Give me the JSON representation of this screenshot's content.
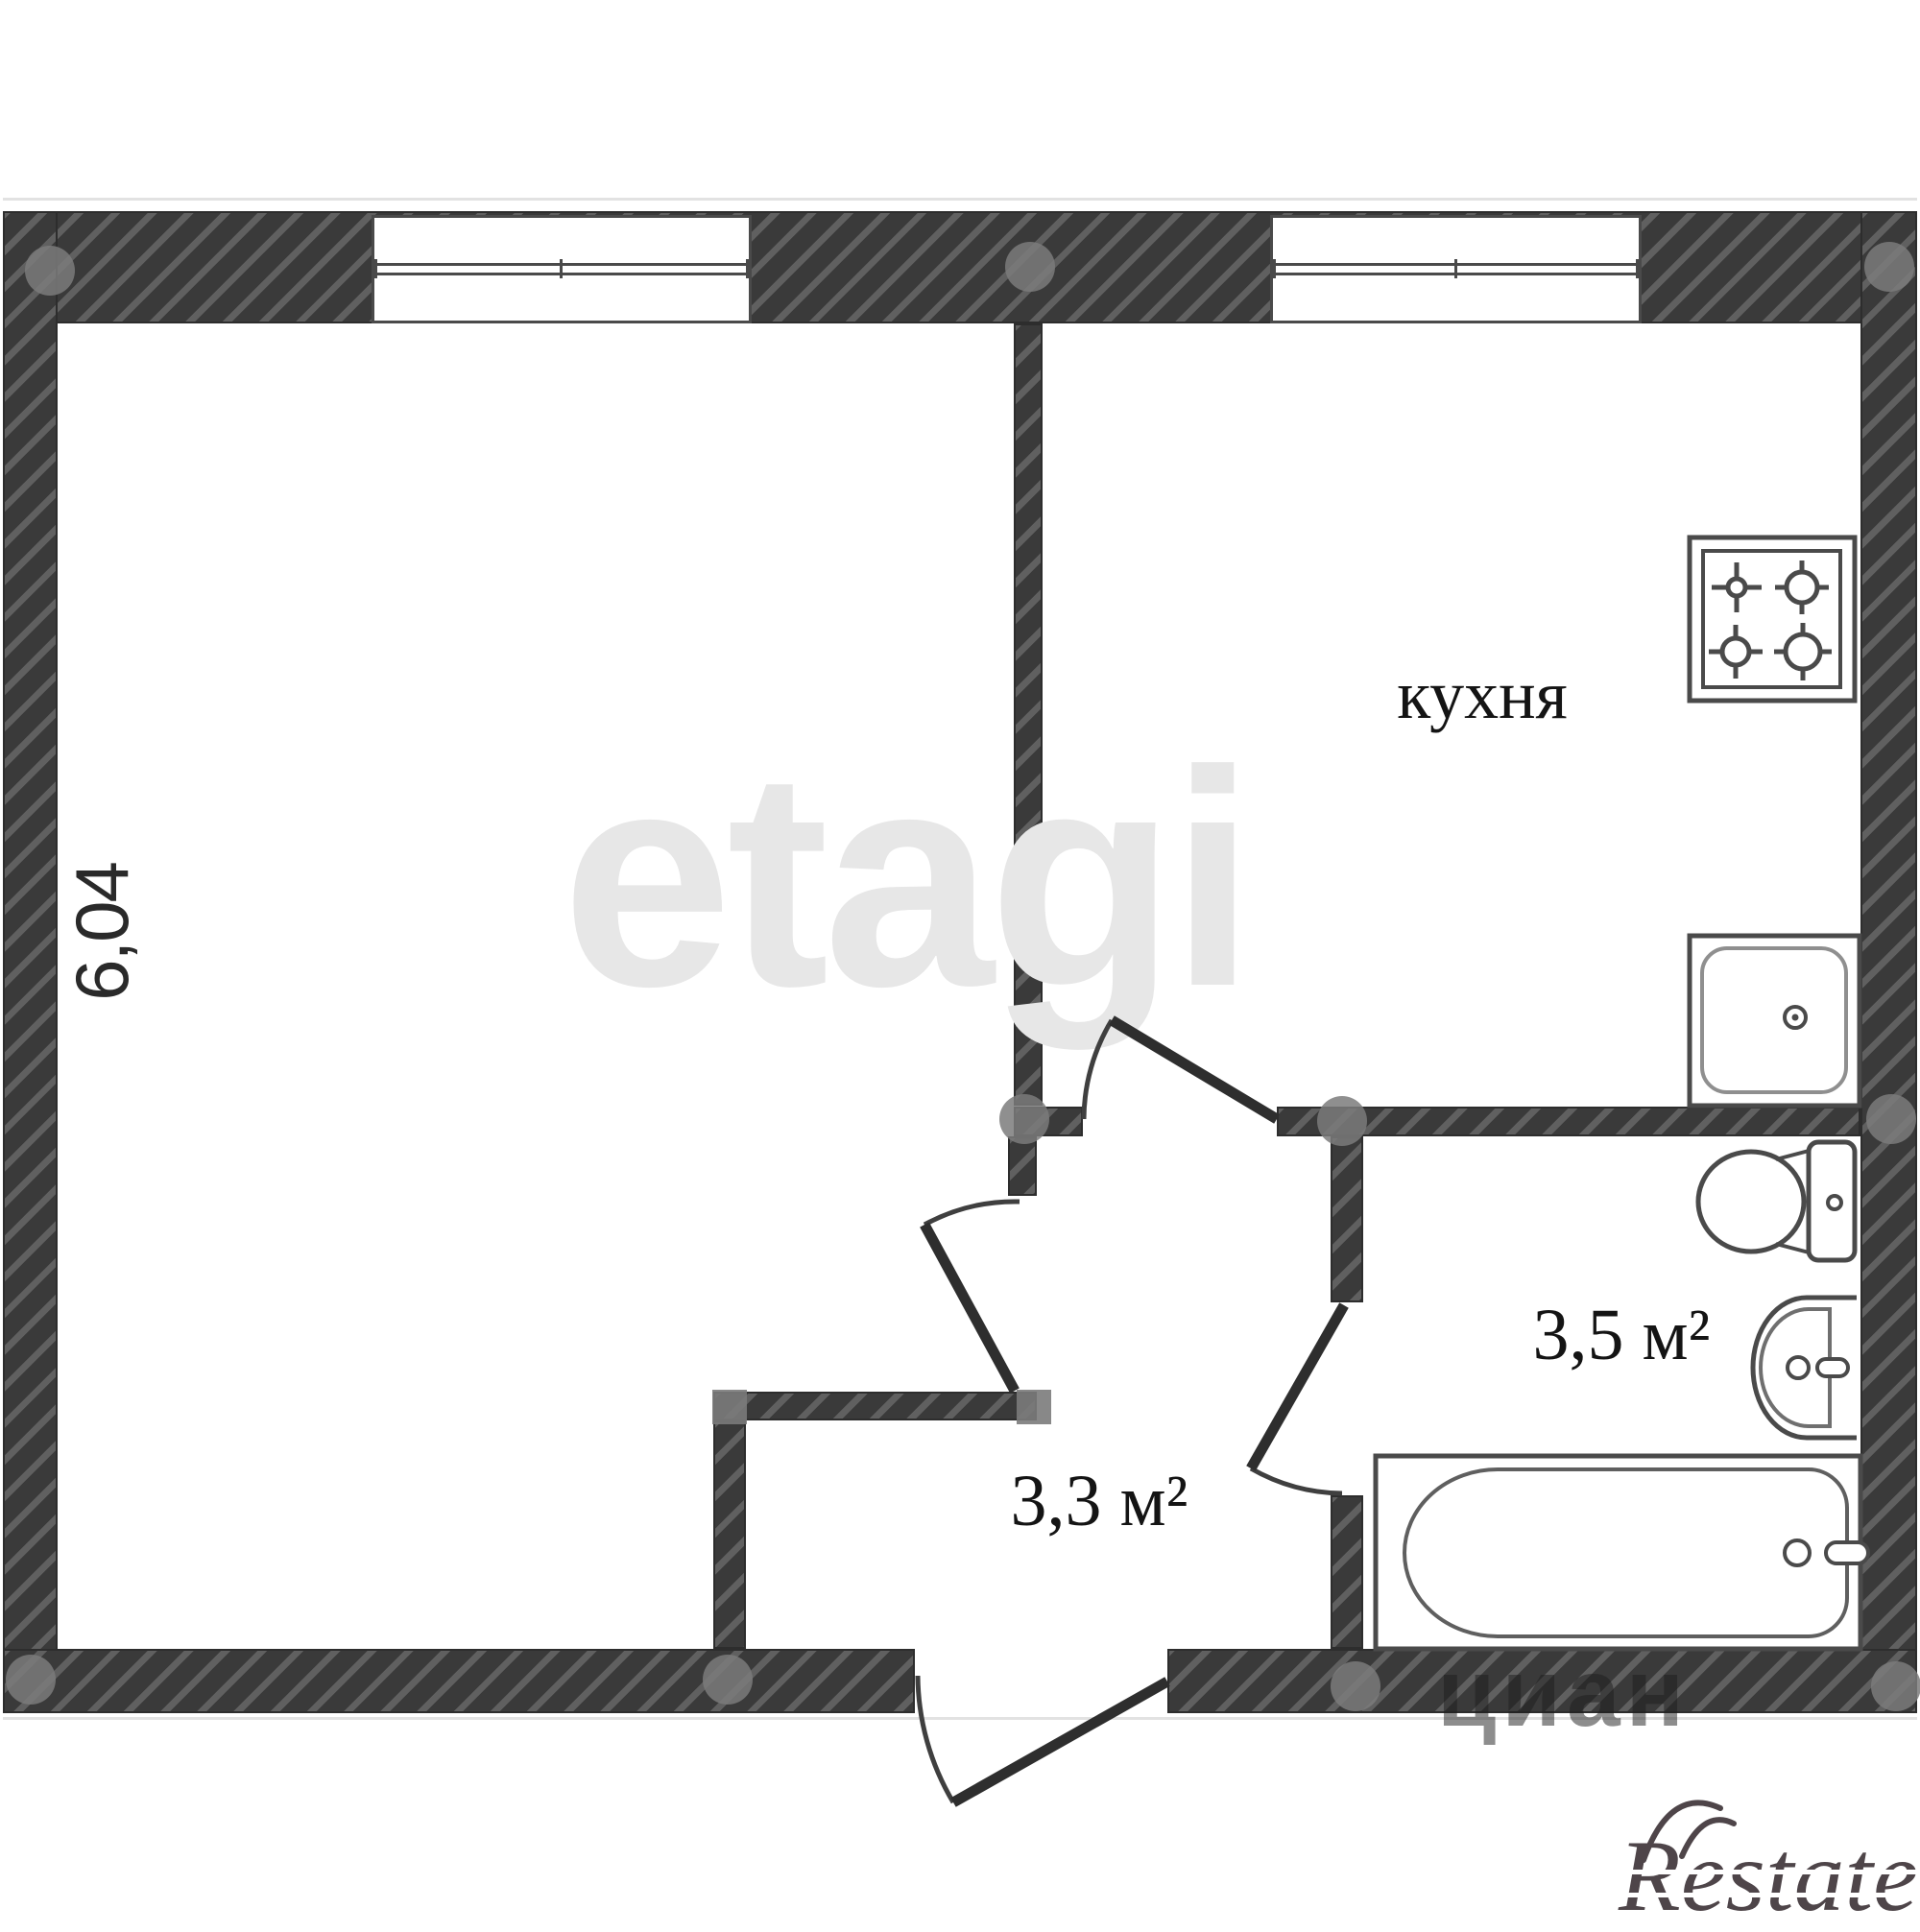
{
  "plan": {
    "title": "apartment-floor-plan",
    "rooms": [
      {
        "name": "living-room",
        "label": "6,04"
      },
      {
        "name": "kitchen",
        "label": "кухня"
      },
      {
        "name": "bathroom",
        "label": "3,5 м²"
      },
      {
        "name": "hallway",
        "label": "3,3 м²"
      }
    ],
    "fixtures": [
      "stove",
      "kitchen-sink",
      "toilet",
      "washbasin",
      "bathtub"
    ],
    "doors": [
      "kitchen-door",
      "living-room-door",
      "bathroom-door",
      "entrance-door"
    ],
    "windows": [
      "living-room-window",
      "kitchen-window"
    ],
    "colors": {
      "wall_dark": "#3a3a3a",
      "wall_stripe": "#606060",
      "fixture_stroke": "#4a4a4a",
      "junction_dot": "#7b7b7b",
      "label_text": "#141414",
      "watermark_gray": "#e7e7e7",
      "logo_color": "#4e4549"
    }
  },
  "watermarks": {
    "center_brand": "etagi",
    "wall_brand": "циан",
    "corner_logo": "Restate"
  }
}
